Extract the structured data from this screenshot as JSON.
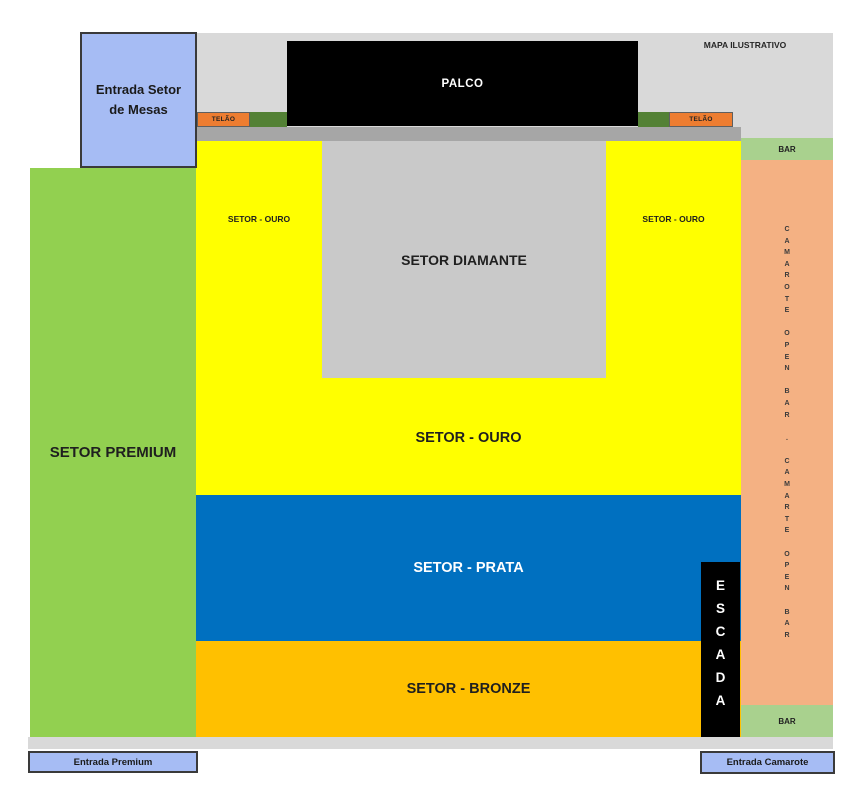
{
  "map": {
    "watermark": "MAPA ILUSTRATIVO",
    "stage_label": "PALCO",
    "screens": {
      "left_label": "TELÃO",
      "right_label": "TELÃO"
    },
    "entrances": {
      "mesas_label": "Entrada Setor de Mesas",
      "premium_label": "Entrada Premium",
      "camarote_label": "Entrada Camarote"
    },
    "sectors": {
      "premium_label": "SETOR PREMIUM",
      "ouro_left_label": "SETOR - OURO",
      "ouro_right_label": "SETOR - OURO",
      "ouro_main_label": "SETOR - OURO",
      "diamante_label": "SETOR DIAMANTE",
      "prata_label": "SETOR - PRATA",
      "bronze_label": "SETOR - BRONZE",
      "escada_label": "ESCADA",
      "camarote_vertical_label": "CAMAROTE OPEN BAR . CAMARTE OPEN BAR",
      "bar_top_label": "BAR",
      "bar_bottom_label": "BAR"
    },
    "colors": {
      "premium_green": "#92d050",
      "ouro_yellow": "#ffff00",
      "diamante_gray": "#c9c9c9",
      "prata_blue": "#0070c0",
      "bronze_gold": "#ffc000",
      "camarote_salmon": "#f4b183",
      "bar_green": "#a9d18e",
      "telao_orange": "#ed7d31",
      "screen_dark_green": "#538135",
      "stage_black": "#000000",
      "walkway_gray": "#d9d9d9",
      "stage_apron_gray": "#a6a6a6",
      "entrance_blue": "#a6bcf4"
    }
  }
}
